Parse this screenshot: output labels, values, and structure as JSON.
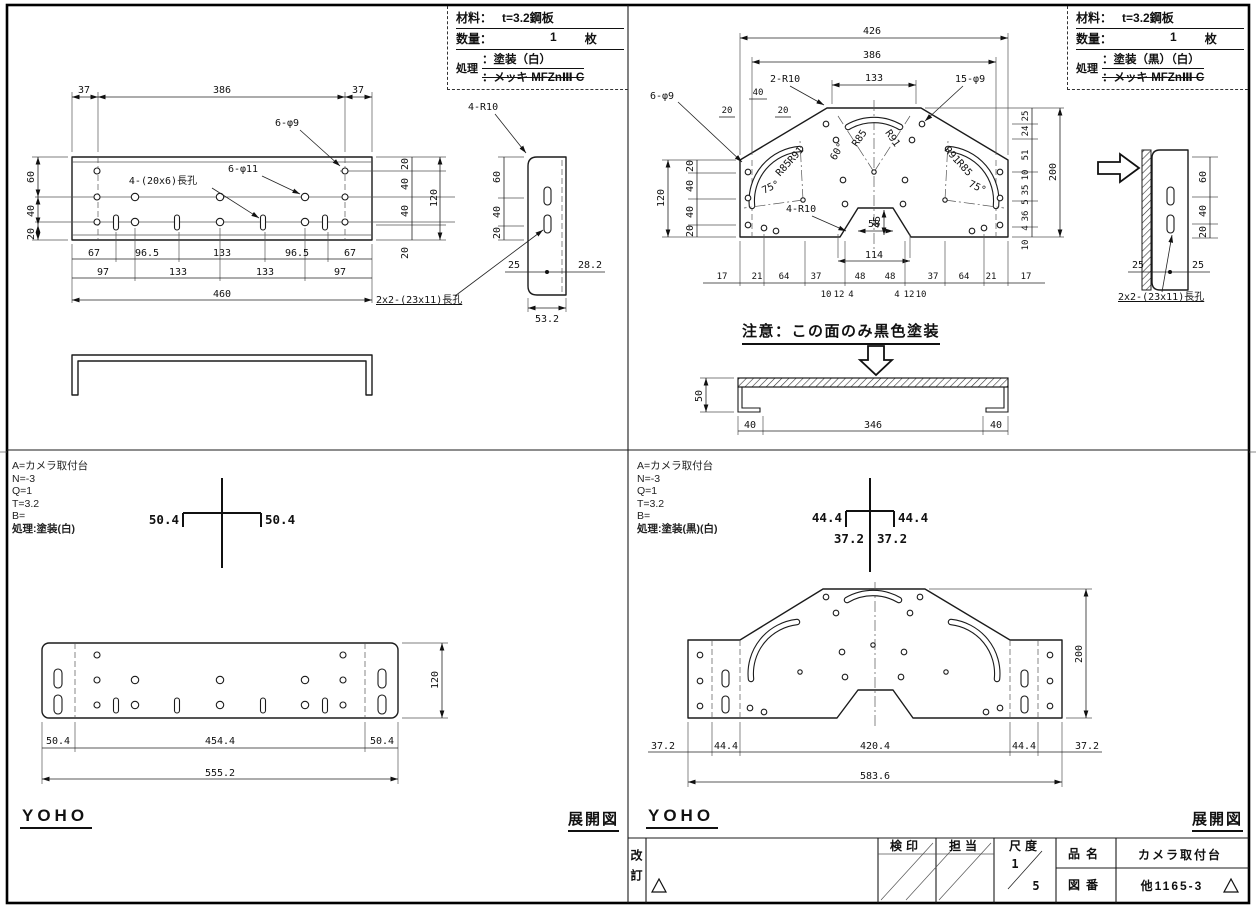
{
  "left": {
    "mat": {
      "material_label": "材料：",
      "material_value": "t=3.2鋼板",
      "qty_label": "数量：",
      "qty_value": "1",
      "qty_unit": "枚",
      "process_label": "処理",
      "process_value": "：塗装（白）",
      "process_struck": "：メッキ MFZnⅢ C"
    },
    "plan": {
      "dim_top": [
        "37",
        "386",
        "37"
      ],
      "label_6phi9": "6-φ9",
      "label_6phi11": "6-φ11",
      "label_slot20x6": "4-(20x6)長孔",
      "label_slot23x11": "2x2-(23x11)長孔",
      "dim_left": [
        "60",
        "40",
        "20"
      ],
      "dim_right": [
        "20",
        "40",
        "40",
        "20"
      ],
      "dim_right_total": "120",
      "dim_b1": [
        "67",
        "96.5",
        "133",
        "96.5",
        "67"
      ],
      "dim_b2": [
        "97",
        "133",
        "133",
        "97"
      ],
      "dim_b3": "460"
    },
    "side": {
      "label_4r10": "4-R10",
      "dim_v": [
        "60",
        "40",
        "20"
      ],
      "dim_25": "25",
      "dim_282": "28.2",
      "dim_532": "53.2"
    },
    "meta_text": "A=カメラ取付台\nN=-3\nQ=1\nT=3.2\nB=",
    "meta_process": "処理:塗装(白)",
    "bend": {
      "left": "50.4",
      "right": "50.4"
    },
    "flat": {
      "dim_h": "120",
      "dim_b1": [
        "50.4",
        "454.4",
        "50.4"
      ],
      "dim_b2": "555.2"
    },
    "logo": "YOHO",
    "tenkai": "展開図"
  },
  "right": {
    "mat": {
      "material_label": "材料：",
      "material_value": "t=3.2鋼板",
      "qty_label": "数量：",
      "qty_value": "1",
      "qty_unit": "枚",
      "process_label": "処理",
      "process_value": "：塗装（黒）（白）",
      "process_struck": "：メッキ MFZnⅢ C"
    },
    "plan": {
      "dim_top": [
        "426",
        "386",
        "133"
      ],
      "label_2r10": "2-R10",
      "label_15phi9": "15-φ9",
      "label_6phi9": "6-φ9",
      "label_4r10": "4-R10",
      "dim_small_top": [
        "40",
        "20",
        "20"
      ],
      "dim_left": [
        "20",
        "40",
        "40",
        "20"
      ],
      "dim_left_total": "120",
      "dim_right": [
        "25",
        "24",
        "51",
        "10",
        "35",
        "5",
        "36",
        "4",
        "10"
      ],
      "dim_right_total": "200",
      "arc_left": {
        "r1": "R85",
        "r2": "R91",
        "ang": "75°"
      },
      "arc_center": {
        "r1": "R85",
        "r2": "R91",
        "ang": "60°"
      },
      "arc_right": {
        "r1": "R91",
        "r2": "R85",
        "ang": "75°"
      },
      "dim_114": "114",
      "dim_58": "58",
      "dim_45": "45",
      "dim_bottom": [
        "17",
        "21",
        "64",
        "37",
        "48",
        "48",
        "37",
        "64",
        "21",
        "17"
      ],
      "dim_bottom_small": [
        "10",
        "12",
        "4",
        "4",
        "12",
        "10"
      ]
    },
    "side": {
      "dim_v": [
        "60",
        "40",
        "20"
      ],
      "dim_25a": "25",
      "dim_25b": "25",
      "label_slot23x11": "2x2-(23x11)長孔"
    },
    "note": "注意：この面のみ黒色塗装",
    "section": {
      "dim_h": "50",
      "dim_b": [
        "40",
        "346",
        "40"
      ]
    },
    "meta_text": "A=カメラ取付台\nN=-3\nQ=1\nT=3.2\nB=",
    "meta_process": "処理:塗装(黒)(白)",
    "bend": {
      "l1": "44.4",
      "r1": "44.4",
      "l2": "37.2",
      "r2": "37.2"
    },
    "flat": {
      "dim_h": "200",
      "dim_b1": [
        "37.2",
        "44.4",
        "420.4",
        "44.4",
        "37.2"
      ],
      "dim_b2": "583.6"
    },
    "logo": "YOHO",
    "tenkai": "展開図"
  },
  "titleblock": {
    "revision_label": "改訂",
    "check_label": "検印",
    "charge_label": "担当",
    "scale_label": "尺度",
    "scale_num": "1",
    "scale_den": "5",
    "name_label": "品名",
    "name_value": "カメラ取付台",
    "no_label": "図番",
    "no_value": "他1165-3"
  }
}
